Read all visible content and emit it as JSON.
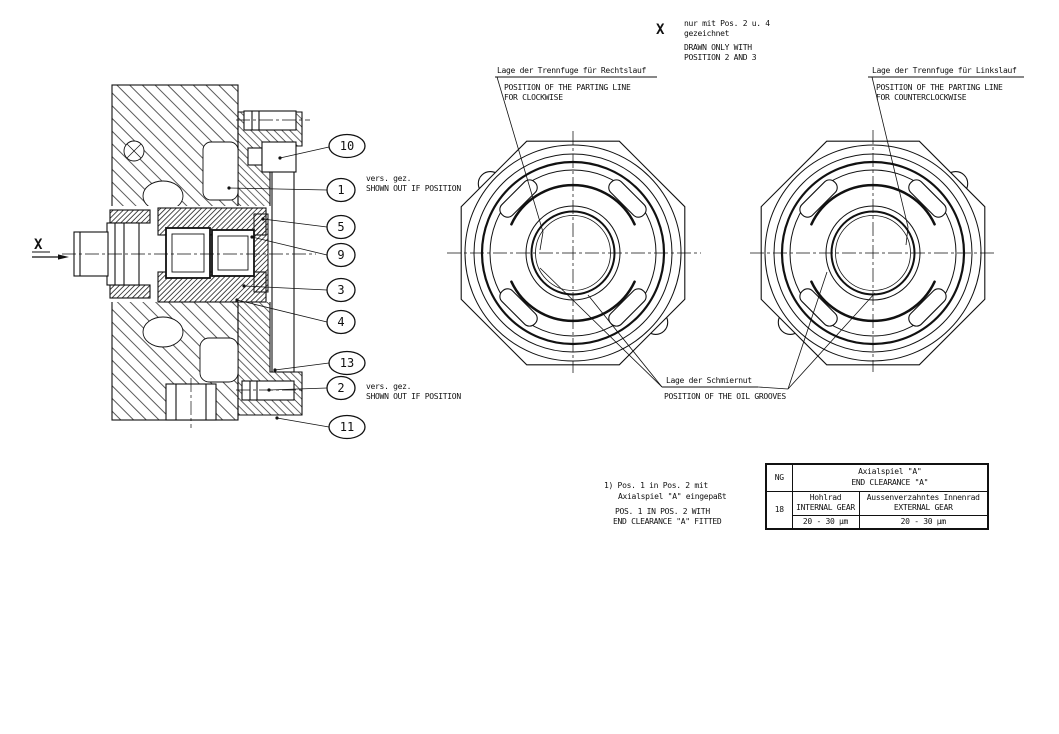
{
  "note_top_right": {
    "marker": "X",
    "de1": "nur mit Pos. 2 u. 4",
    "de2": "gezeichnet",
    "en1": "DRAWN ONLY WITH",
    "en2": "POSITION 2 AND 3"
  },
  "section": {
    "view_marker": "X",
    "balloons": [
      "10",
      "1",
      "5",
      "9",
      "3",
      "4",
      "13",
      "2",
      "11"
    ],
    "offset_note_top": {
      "de": "vers. gez.",
      "en": "SHOWN OUT IF POSITION"
    },
    "offset_note_bottom": {
      "de": "vers. gez.",
      "en": "SHOWN OUT IF POSITION"
    }
  },
  "cw_view": {
    "de": "Lage der Trennfuge für Rechtslauf",
    "en1": "POSITION OF THE PARTING LINE",
    "en2": "FOR CLOCKWISE"
  },
  "ccw_view": {
    "de": "Lage der Trennfuge für Linkslauf",
    "en1": "POSITION OF THE PARTING LINE",
    "en2": "FOR COUNTERCLOCKWISE"
  },
  "oil": {
    "de": "Lage der Schmiernut",
    "en": "POSITION OF THE OIL GROOVES"
  },
  "footnote": {
    "de1": "1) Pos. 1 in Pos. 2 mit",
    "de2": "Axialspiel \"A\" eingepaßt",
    "en1": "POS. 1 IN POS. 2 WITH",
    "en2": "END CLEARANCE \"A\" FITTED"
  },
  "table": {
    "ng_label": "NG",
    "ng_value": "18",
    "title_de": "Axialspiel \"A\"",
    "title_en": "END CLEARANCE \"A\"",
    "col1_de": "Hohlrad",
    "col1_en": "INTERNAL GEAR",
    "col2_de": "Aussenverzahntes Innenrad",
    "col2_en": "EXTERNAL GEAR",
    "val1": "20 - 30 µm",
    "val2": "20 - 30 µm"
  }
}
